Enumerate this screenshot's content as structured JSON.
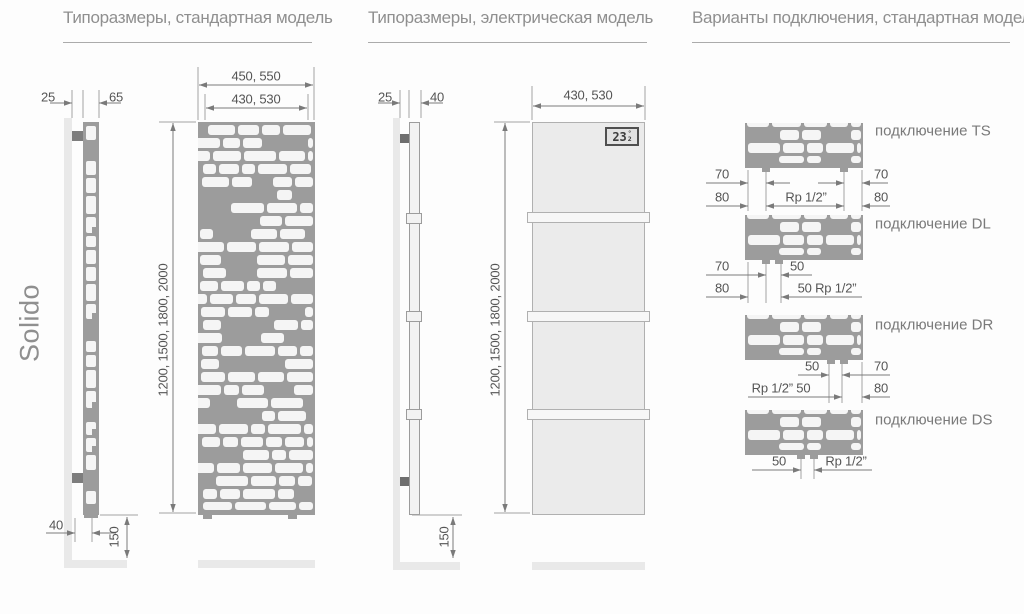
{
  "brand": "Solido",
  "colors": {
    "pattern_gray": "#9c9c9c",
    "pattern_white": "#f5f5f5",
    "panel_light": "#ebebeb",
    "wall_gray": "#e9e9e9",
    "dim_line": "#7a7a7a",
    "ext_line": "#a3a3a3",
    "dim_text": "#555555",
    "title_text": "#8f8f8f"
  },
  "sections": {
    "standard": {
      "title": "Типоразмеры, стандартная модель",
      "dims": {
        "wall_gap": "25",
        "depth": "65",
        "width_outer": "450, 550",
        "width_inner": "430, 530",
        "heights": "1200, 1500, 1800, 2000",
        "bottom_offset": "40",
        "floor_clearance": "150"
      }
    },
    "electric": {
      "title": "Типоразмеры, электрическая модель",
      "dims": {
        "wall_gap": "25",
        "depth": "40",
        "width_inner": "430, 530",
        "heights": "1200, 1500, 1800, 2000",
        "floor_clearance": "150"
      },
      "display": {
        "value": "23",
        "degree": "°",
        "half": "2"
      }
    },
    "connections": {
      "title": "Варианты подключения, стандартная модель",
      "items": [
        {
          "id": "TS",
          "label": "подключение TS",
          "dims": [
            "70",
            "70",
            "80",
            "Rp 1/2”",
            "80"
          ]
        },
        {
          "id": "DL",
          "label": "подключение DL",
          "dims": [
            "70",
            "50",
            "80",
            "50 Rp 1/2”"
          ]
        },
        {
          "id": "DR",
          "label": "подключение DR",
          "dims": [
            "50",
            "70",
            "Rp 1/2” 50",
            "80"
          ]
        },
        {
          "id": "DS",
          "label": "подключение DS",
          "dims": [
            "50",
            "Rp 1/2”"
          ]
        }
      ]
    }
  }
}
